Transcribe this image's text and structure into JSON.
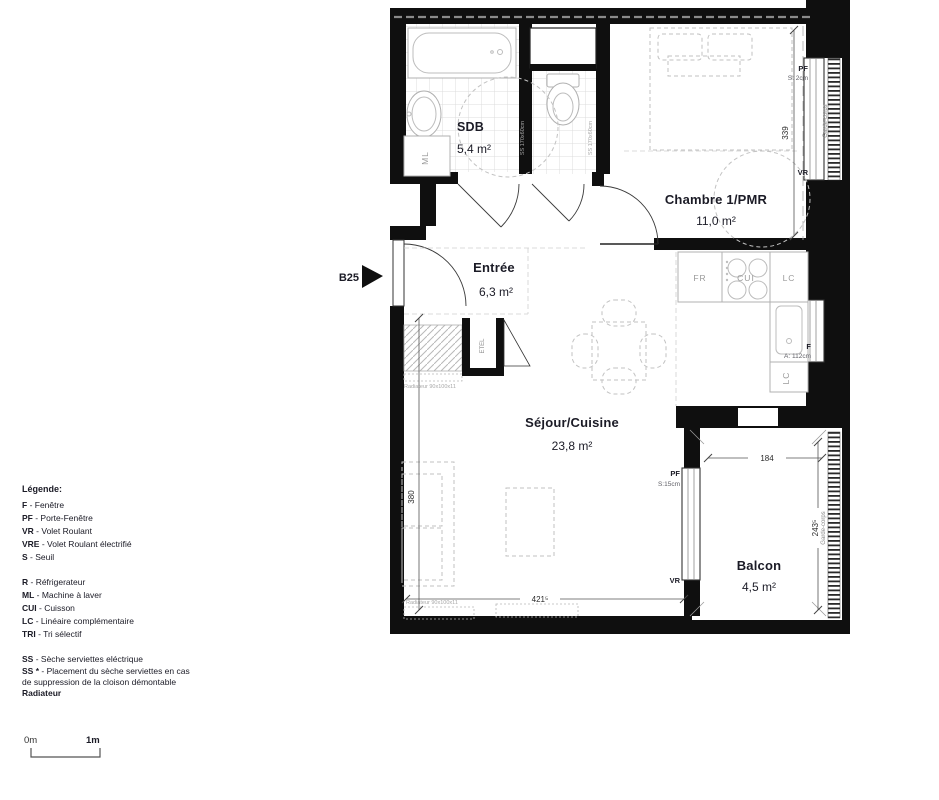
{
  "marker": {
    "label": "B25"
  },
  "rooms": {
    "sdb": {
      "name": "SDB",
      "area": "5,4 m²"
    },
    "chambre": {
      "name": "Chambre 1/PMR",
      "area": "11,0 m²"
    },
    "entree": {
      "name": "Entrée",
      "area": "6,3 m²"
    },
    "sejour": {
      "name": "Séjour/Cuisine",
      "area": "23,8 m²"
    },
    "balcon": {
      "name": "Balcon",
      "area": "4,5 m²"
    }
  },
  "labels": {
    "pf_chambre": "PF",
    "seuil_chambre": "S: 2cm",
    "vr_chambre": "VR",
    "garde_corps_chambre": "Garde-corps",
    "dim_chambre": "339",
    "fridge": "FR",
    "cooktop": "CUI",
    "lc_counter": "LC",
    "lc_side": "LC",
    "window_kitchen": "F",
    "allege_kitchen": "A: 112cm",
    "washing_machine": "ML",
    "etel": "ETEL",
    "ss_sdb": "SS 170x60cm",
    "ss_wc": "SS 170x60cm",
    "radiator_entree": "Radiateur 90x100x11",
    "radiator_sejour": "Radiateur 90x100x11",
    "dim_sejour_height": "380",
    "dim_sejour_width": "421⁵",
    "dim_balcon_width": "184",
    "dim_balcon_height": "243⁵",
    "pf_balcon": "PF",
    "seuil_balcon": "S:15cm",
    "vr_balcon": "VR",
    "garde_corps_balcon": "Garde-corps"
  },
  "legend": {
    "title": "Légende:",
    "groups": [
      {
        "items": [
          {
            "abbr": "F",
            "rest": " - Fenêtre"
          },
          {
            "abbr": "PF",
            "rest": " - Porte-Fenêtre"
          },
          {
            "abbr": "VR",
            "rest": " - Volet Roulant"
          },
          {
            "abbr": "VRE",
            "rest": " - Volet Roulant électrifié"
          },
          {
            "abbr": "S",
            "rest": " - Seuil"
          }
        ]
      },
      {
        "items": [
          {
            "abbr": "R",
            "rest": " - Réfrigerateur"
          },
          {
            "abbr": "ML",
            "rest": " - Machine à laver"
          },
          {
            "abbr": "CUI",
            "rest": " - Cuisson"
          },
          {
            "abbr": "LC",
            "rest": " - Linéaire complémentaire"
          },
          {
            "abbr": "TRI",
            "rest": " - Tri sélectif"
          }
        ]
      },
      {
        "items": [
          {
            "abbr": "SS",
            "rest": " - Sèche serviettes eléctrique"
          }
        ]
      }
    ],
    "note": {
      "abbr": "SS *",
      "rest": " - Placement du sèche serviettes en cas de suppression de la cloison démontable"
    },
    "footer": "Radiateur"
  },
  "scale": {
    "start": "0m",
    "end": "1m"
  },
  "colors": {
    "wall": "#0f0f0f",
    "text": "#1b1b26",
    "furniture": "#bfbfbf"
  }
}
